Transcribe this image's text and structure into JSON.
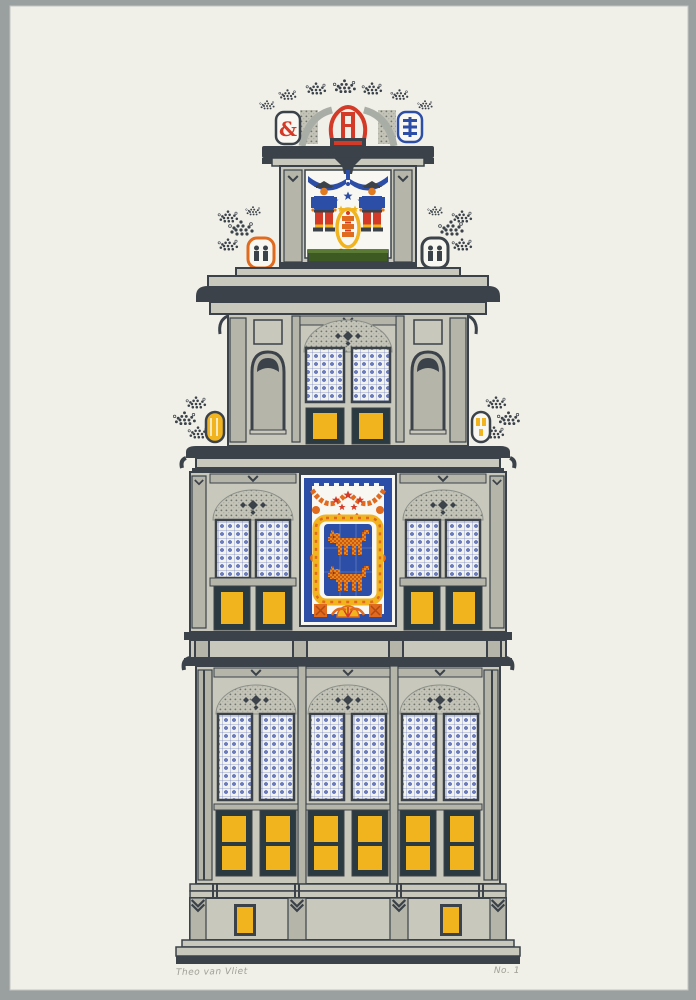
{
  "artwork": {
    "signature": "Theo van Vliet",
    "edition": "No. 1"
  },
  "palette": {
    "background": "#9aa09f",
    "paper": "#f0efe8",
    "building_light": "#c9c8bc",
    "building_mid": "#b5b5aa",
    "outline_dark": "#3b4249",
    "shutter_navy": "#2b3940",
    "yellow": "#f1b41f",
    "orange": "#e06a1d",
    "red": "#d43a28",
    "blue": "#2c4ea6",
    "lattice_blue": "#4c60b4",
    "green": "#3e5a23",
    "white": "#f8f7f1",
    "pencil": "#a0a096"
  }
}
